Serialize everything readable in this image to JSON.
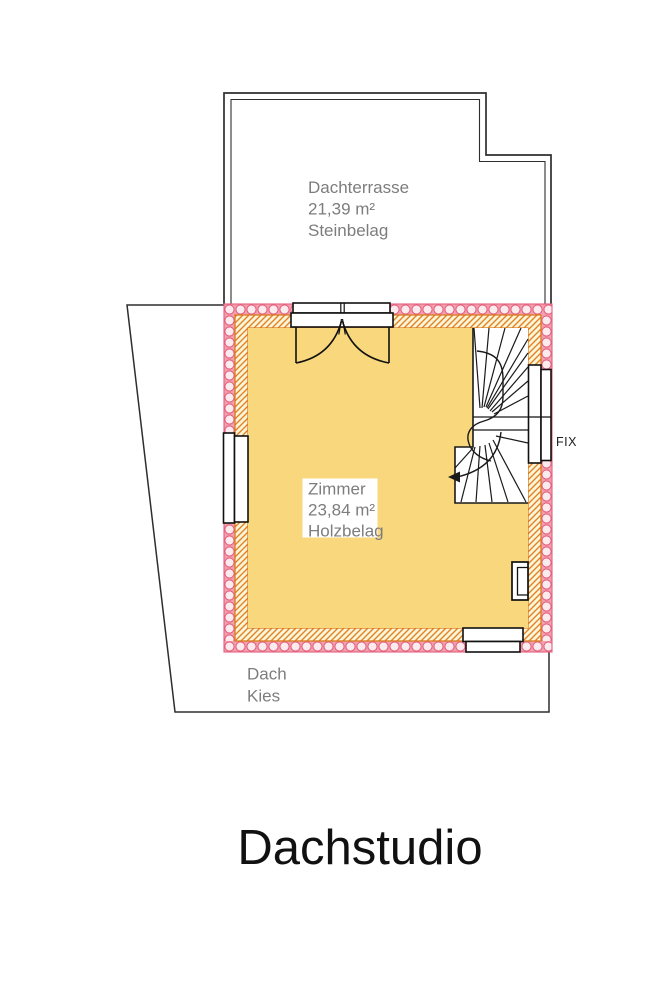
{
  "title": "Dachstudio",
  "terrace": {
    "name": "Dachterrasse",
    "area": "21,39 m²",
    "flooring": "Steinbelag"
  },
  "room": {
    "name": "Zimmer",
    "area": "23,84 m²",
    "flooring": "Holzbelag"
  },
  "roof": {
    "name": "Dach",
    "covering": "Kies"
  },
  "windows": {
    "fix_label": "FIX"
  },
  "colors": {
    "room_fill": "#F8D77D",
    "hatch_bg": "#FCF5D8",
    "hatch_line": "#E08227",
    "wall_border_orange": "#D97A20",
    "insulation_bg": "#F29FAE",
    "insulation_circle_fill": "#FBEBEE",
    "insulation_stroke": "#E4607E",
    "outline_dark": "#2E2E2E",
    "label_gray": "#7D7D7D"
  }
}
